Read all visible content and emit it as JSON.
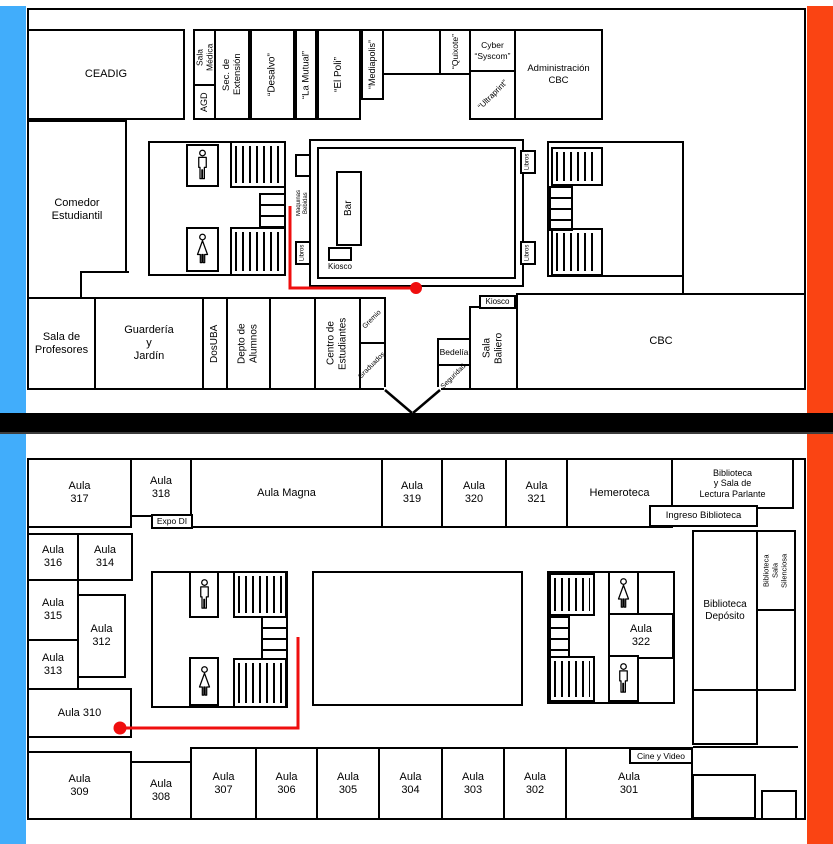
{
  "colors": {
    "blue": "#41adfb",
    "orange": "#fa4413",
    "path_red": "#ef0e0e"
  },
  "icons": {
    "male_wc": "male-wc-icon",
    "female_wc": "female-wc-icon",
    "stairs": "stairs-hatch",
    "steps": "steps"
  },
  "f1": {
    "ceadig": "CEADIG",
    "sala_medica": "Sala\nMédica",
    "agd": "AGD",
    "sec_extension": "Sec. de\nExtensión",
    "desalvo": "“Desalvo”",
    "la_mutual": "“La Mutual”",
    "el_poli": "“El Poli”",
    "mediapolis": "“Mediapolis”",
    "quixote": "“Quixote”",
    "cyber_syscom": "Cyber\n“Syscom”",
    "ultraprint": "“Ultraprint”",
    "admin_cbc": "Administración\nCBC",
    "comedor": "Comedor\nEstudiantil",
    "bar": "Bar",
    "kiosco_bar": "Kiosco",
    "maquinas": "Maquinas\nBebidas",
    "libros": "Libros",
    "sala_profesores": "Sala de\nProfesores",
    "guarderia": "Guardería\ny\nJardín",
    "dosuba": "DosUBA",
    "depto_alumnos": "Depto de\nAlumnos",
    "centro_estudiantes": "Centro de\nEstudiantes",
    "gremio": "Gremio",
    "graduados": "Graduados",
    "bedelia": "Bedelía",
    "seguridad": "Seguridad",
    "sala_baliero": "Sala\nBaliero",
    "kiosco_cbc": "Kiosco",
    "cbc": "CBC"
  },
  "f2": {
    "aula_317": "Aula\n317",
    "aula_318": "Aula\n318",
    "expo_di": "Expo DI",
    "aula_magna": "Aula Magna",
    "aula_319": "Aula\n319",
    "aula_320": "Aula\n320",
    "aula_321": "Aula\n321",
    "hemeroteca": "Hemeroteca",
    "biblioteca_lectura": "Biblioteca\ny Sala de\nLectura Parlante",
    "ingreso_biblioteca": "Ingreso Biblioteca",
    "aula_316": "Aula\n316",
    "aula_314": "Aula\n314",
    "aula_315": "Aula\n315",
    "aula_312": "Aula\n312",
    "aula_313": "Aula\n313",
    "aula_310": "Aula 310",
    "aula_322": "Aula\n322",
    "biblioteca_deposito": "Biblioteca\nDepósito",
    "biblioteca_silenciosa": "Biblioteca\nSala\nSilenciosa",
    "cine_video": "Cine y Video",
    "aula_309": "Aula\n309",
    "aula_308": "Aula\n308",
    "aula_307": "Aula\n307",
    "aula_306": "Aula\n306",
    "aula_305": "Aula\n305",
    "aula_304": "Aula\n304",
    "aula_303": "Aula\n303",
    "aula_302": "Aula\n302",
    "aula_301": "Aula\n301"
  }
}
